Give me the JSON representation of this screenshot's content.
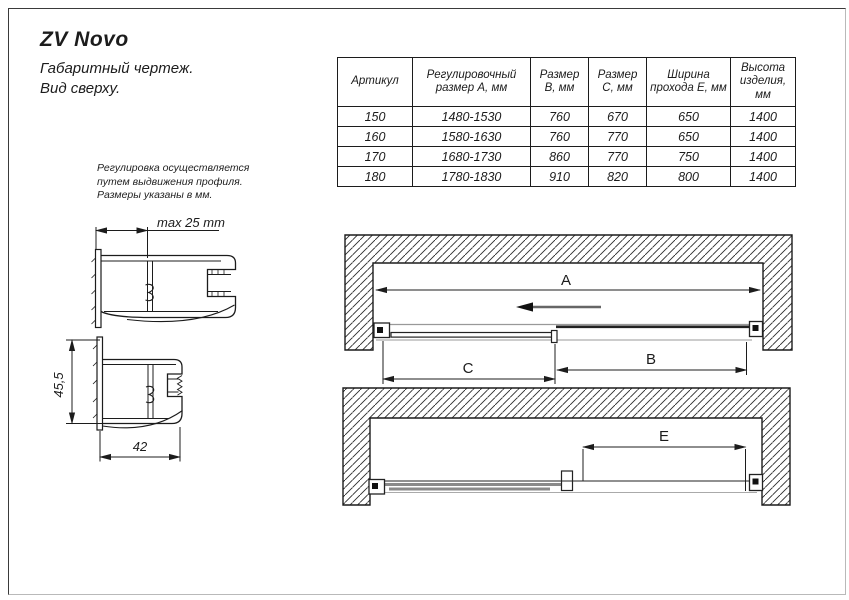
{
  "page": {
    "title": "ZV Novo",
    "subtitle_lines": [
      "Габаритный чертеж.",
      "Вид сверху."
    ],
    "note_lines": [
      "Регулировка осуществляется",
      "путем выдвижения профиля.",
      "Размеры указаны в мм."
    ]
  },
  "table": {
    "headers": [
      "Артикул",
      "Регулировочный\nразмер А, мм",
      "Размер\nВ, мм",
      "Размер\nС, мм",
      "Ширина\nпрохода Е, мм",
      "Высота\nизделия,\nмм"
    ],
    "rows": [
      [
        "150",
        "1480-1530",
        "760",
        "670",
        "650",
        "1400"
      ],
      [
        "160",
        "1580-1630",
        "760",
        "770",
        "650",
        "1400"
      ],
      [
        "170",
        "1680-1730",
        "860",
        "770",
        "750",
        "1400"
      ],
      [
        "180",
        "1780-1830",
        "910",
        "820",
        "800",
        "1400"
      ]
    ]
  },
  "dims": {
    "a": "A",
    "b": "B",
    "c": "C",
    "e": "E",
    "profile_max": "max 25 mm",
    "profile_height": "45,5",
    "profile_width": "42"
  },
  "colors": {
    "line": "#1c1c1c",
    "panel_gray": "#8a8a8a",
    "rail_gray": "#999999",
    "background": "#ffffff"
  }
}
